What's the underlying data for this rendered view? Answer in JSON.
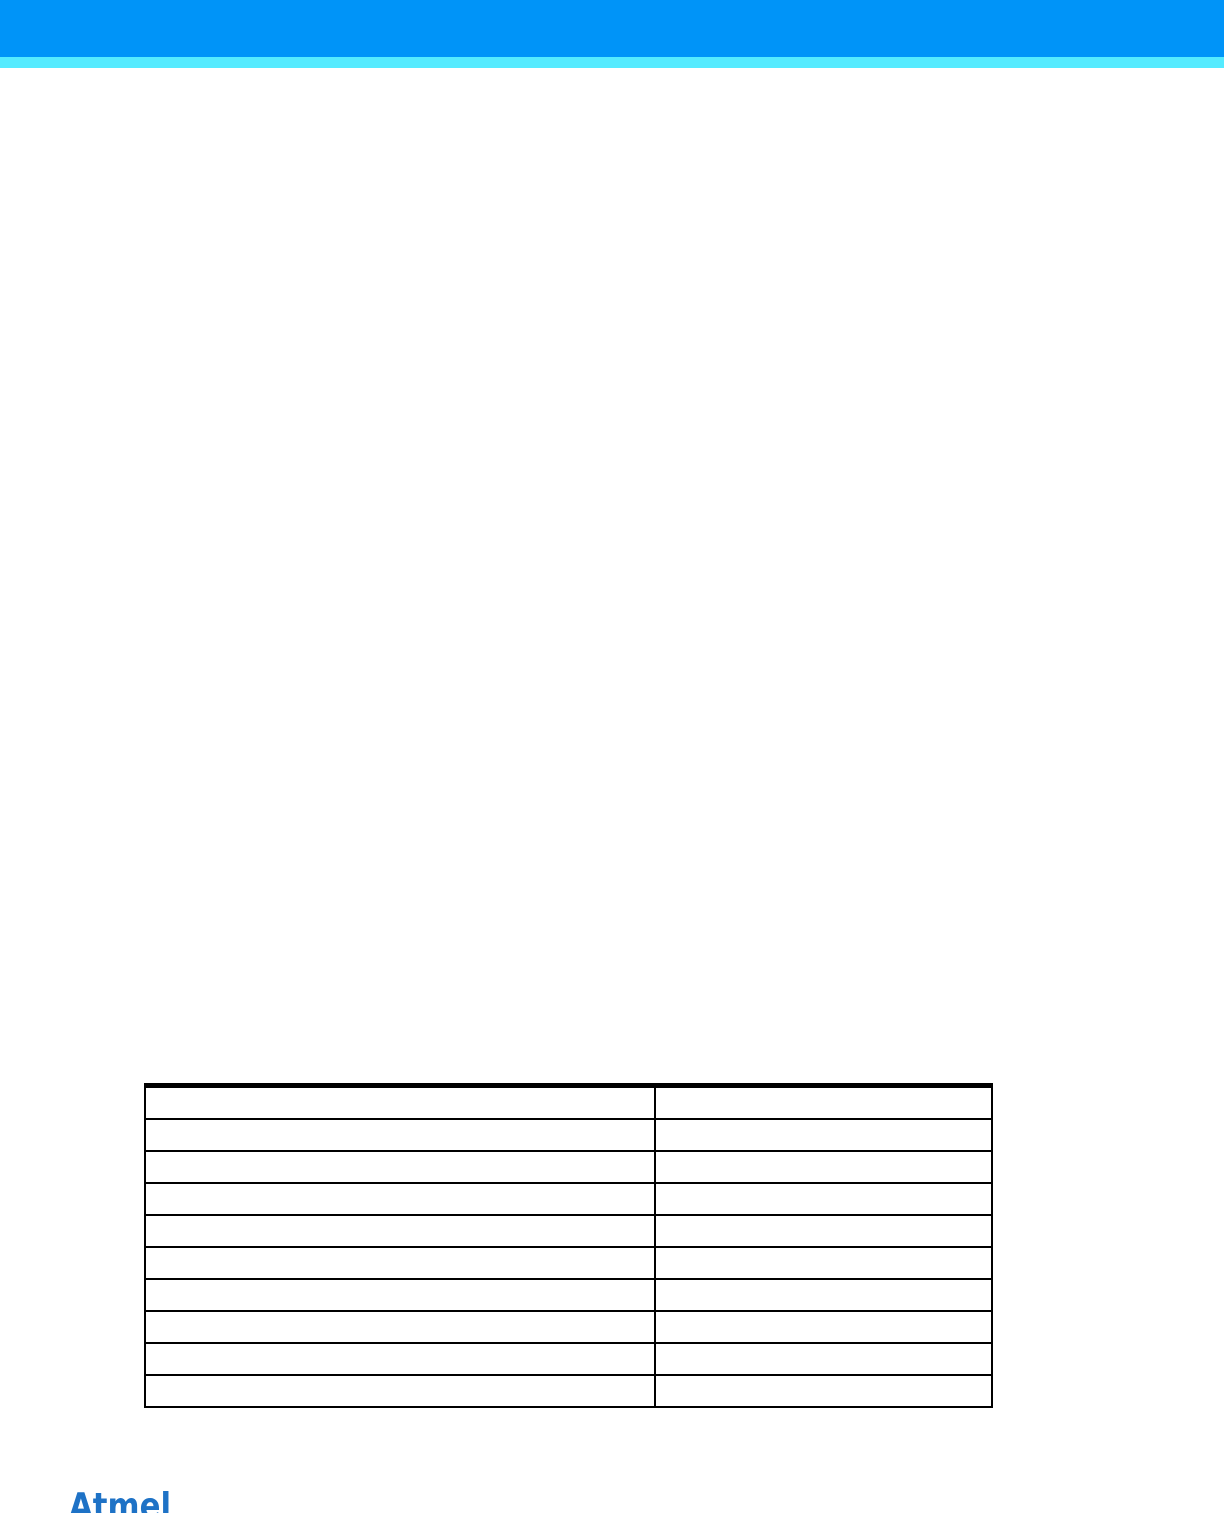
{
  "page": {
    "kind": "datasheet-page",
    "background": "#ffffff"
  },
  "header": {
    "bar_color": "#0094F8",
    "stripe_color": "#55EBFF"
  },
  "table": {
    "border_color": "#000000",
    "header": [
      "",
      ""
    ],
    "rows": [
      [
        "",
        ""
      ],
      [
        "",
        ""
      ],
      [
        "",
        ""
      ],
      [
        "",
        ""
      ],
      [
        "",
        ""
      ],
      [
        "",
        ""
      ],
      [
        "",
        ""
      ],
      [
        "",
        ""
      ],
      [
        "",
        ""
      ]
    ]
  },
  "footer": {
    "logo_text": "Atmel",
    "logo_color": "#1E72C6"
  }
}
